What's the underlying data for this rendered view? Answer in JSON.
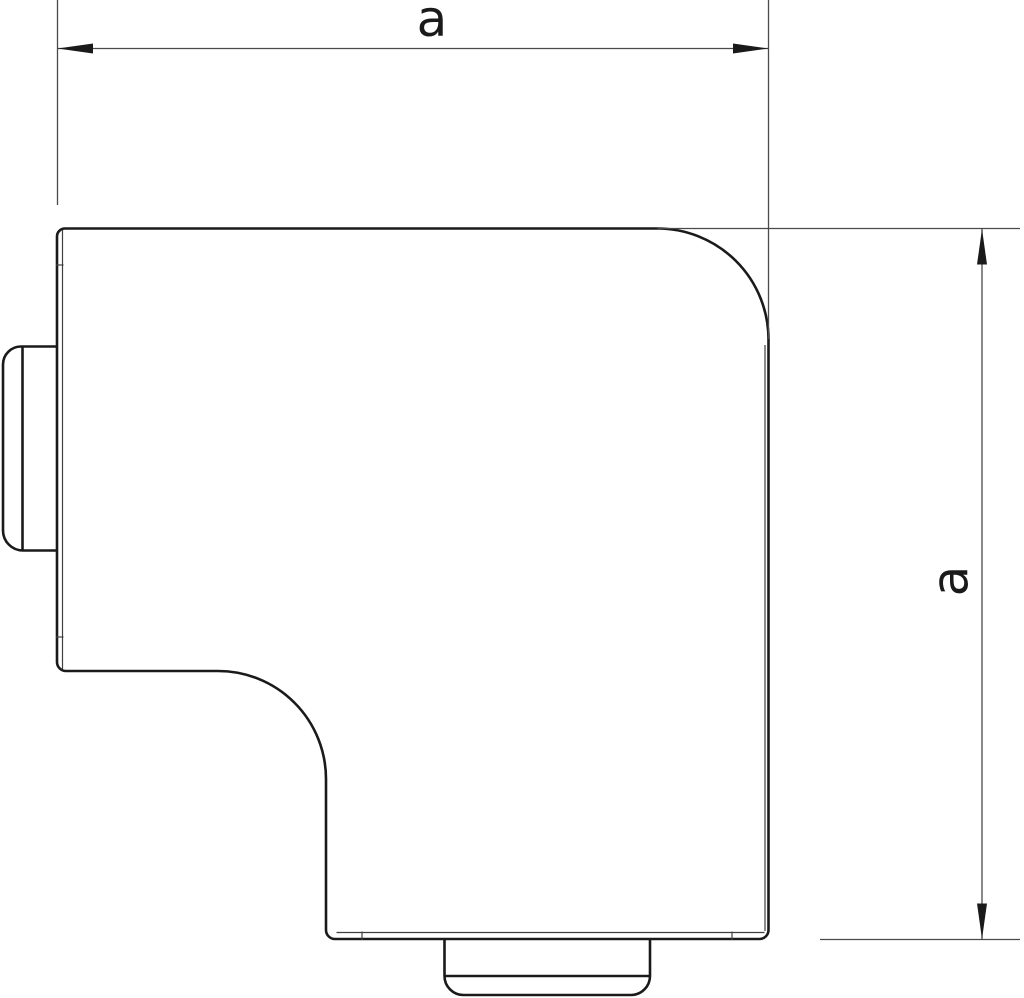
{
  "drawing": {
    "kind": "dimensioned technical line drawing of a flat 90-degree trunking angle piece",
    "background_color": "#ffffff",
    "outline_color": "#1a1a1a",
    "dimension_line_color": "#4a4a4a",
    "dimensions": {
      "horizontal": {
        "label": "a"
      },
      "vertical": {
        "label": "a"
      }
    }
  }
}
